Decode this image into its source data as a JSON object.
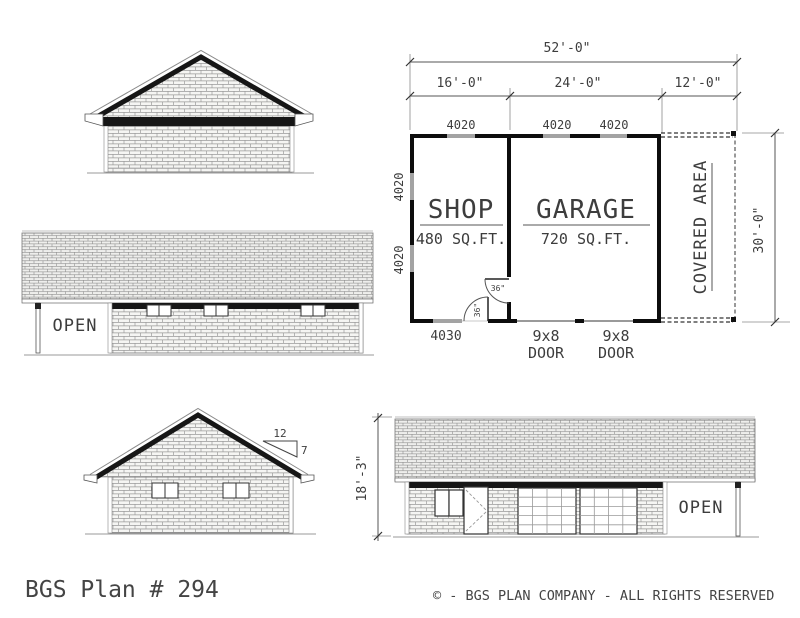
{
  "title": "BGS Plan # 294",
  "copyright": "© - BGS PLAN COMPANY - ALL RIGHTS RESERVED",
  "floor_plan": {
    "dim_overall": "52'-0\"",
    "dim_shop": "16'-0\"",
    "dim_garage": "24'-0\"",
    "dim_covered": "12'-0\"",
    "dim_depth": "30'-0\"",
    "window_4020": "4020",
    "window_4030": "4030",
    "shop_name": "SHOP",
    "shop_area": "480 SQ.FT.",
    "garage_name": "GARAGE",
    "garage_area": "720 SQ.FT.",
    "covered_label": "COVERED AREA",
    "garage_door_size": "9x8",
    "garage_door_word": "DOOR",
    "door_swing": "36\""
  },
  "elevations": {
    "open_label": "OPEN",
    "height_dim": "18'-3\"",
    "pitch_run": "12",
    "pitch_rise": "7"
  }
}
